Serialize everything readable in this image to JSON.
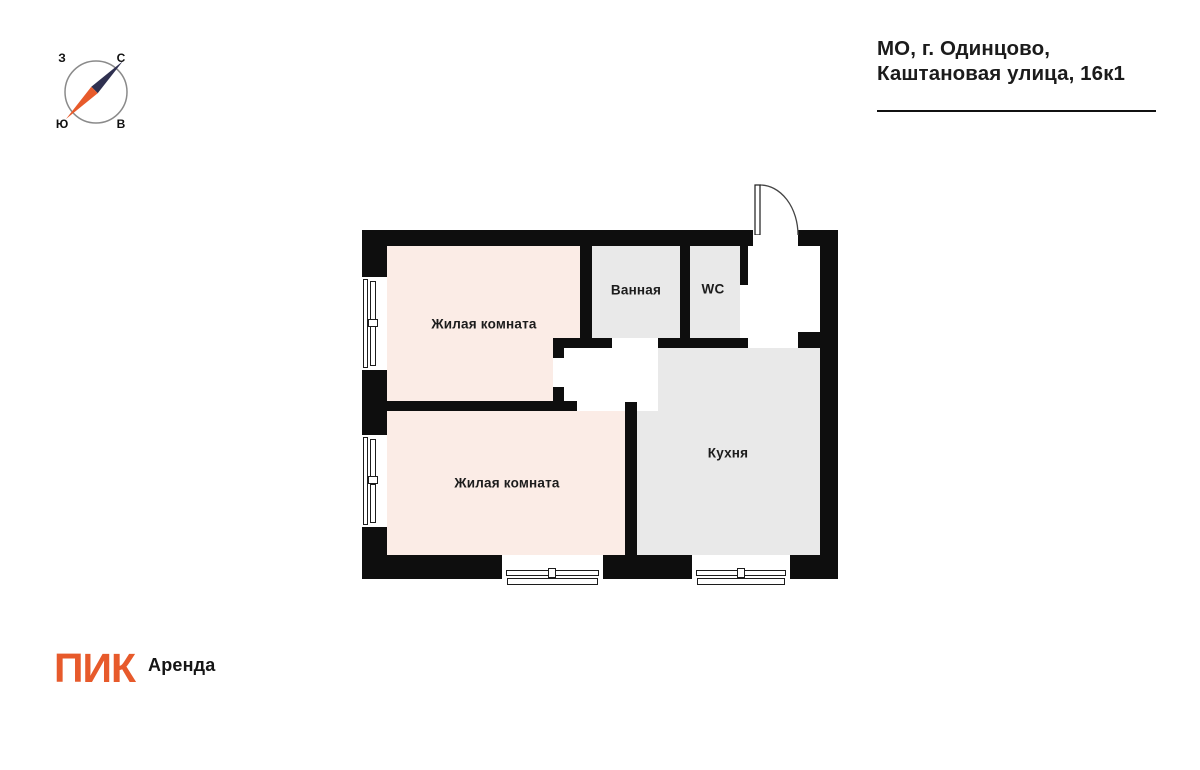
{
  "header": {
    "address_line1": "МО, г. Одинцово,",
    "address_line2": "Каштановая улица, 16к1"
  },
  "compass": {
    "west": "З",
    "north": "С",
    "south": "Ю",
    "east": "В"
  },
  "plan": {
    "rooms": [
      {
        "label": "Жилая комната"
      },
      {
        "label": "Ванная"
      },
      {
        "label": "WC"
      },
      {
        "label": "Кухня"
      },
      {
        "label": "Жилая комната"
      }
    ]
  },
  "footer": {
    "brand": "ПИК",
    "product": "Аренда"
  },
  "colors": {
    "accent_orange": "#E75A2B",
    "room_pink": "#FBECE6",
    "room_gray": "#E9E9E9",
    "wall": "#0E0E0E",
    "needle_navy": "#2F3050",
    "text_dark": "#1B1B1B",
    "compass_ring": "#8A8A8A"
  }
}
